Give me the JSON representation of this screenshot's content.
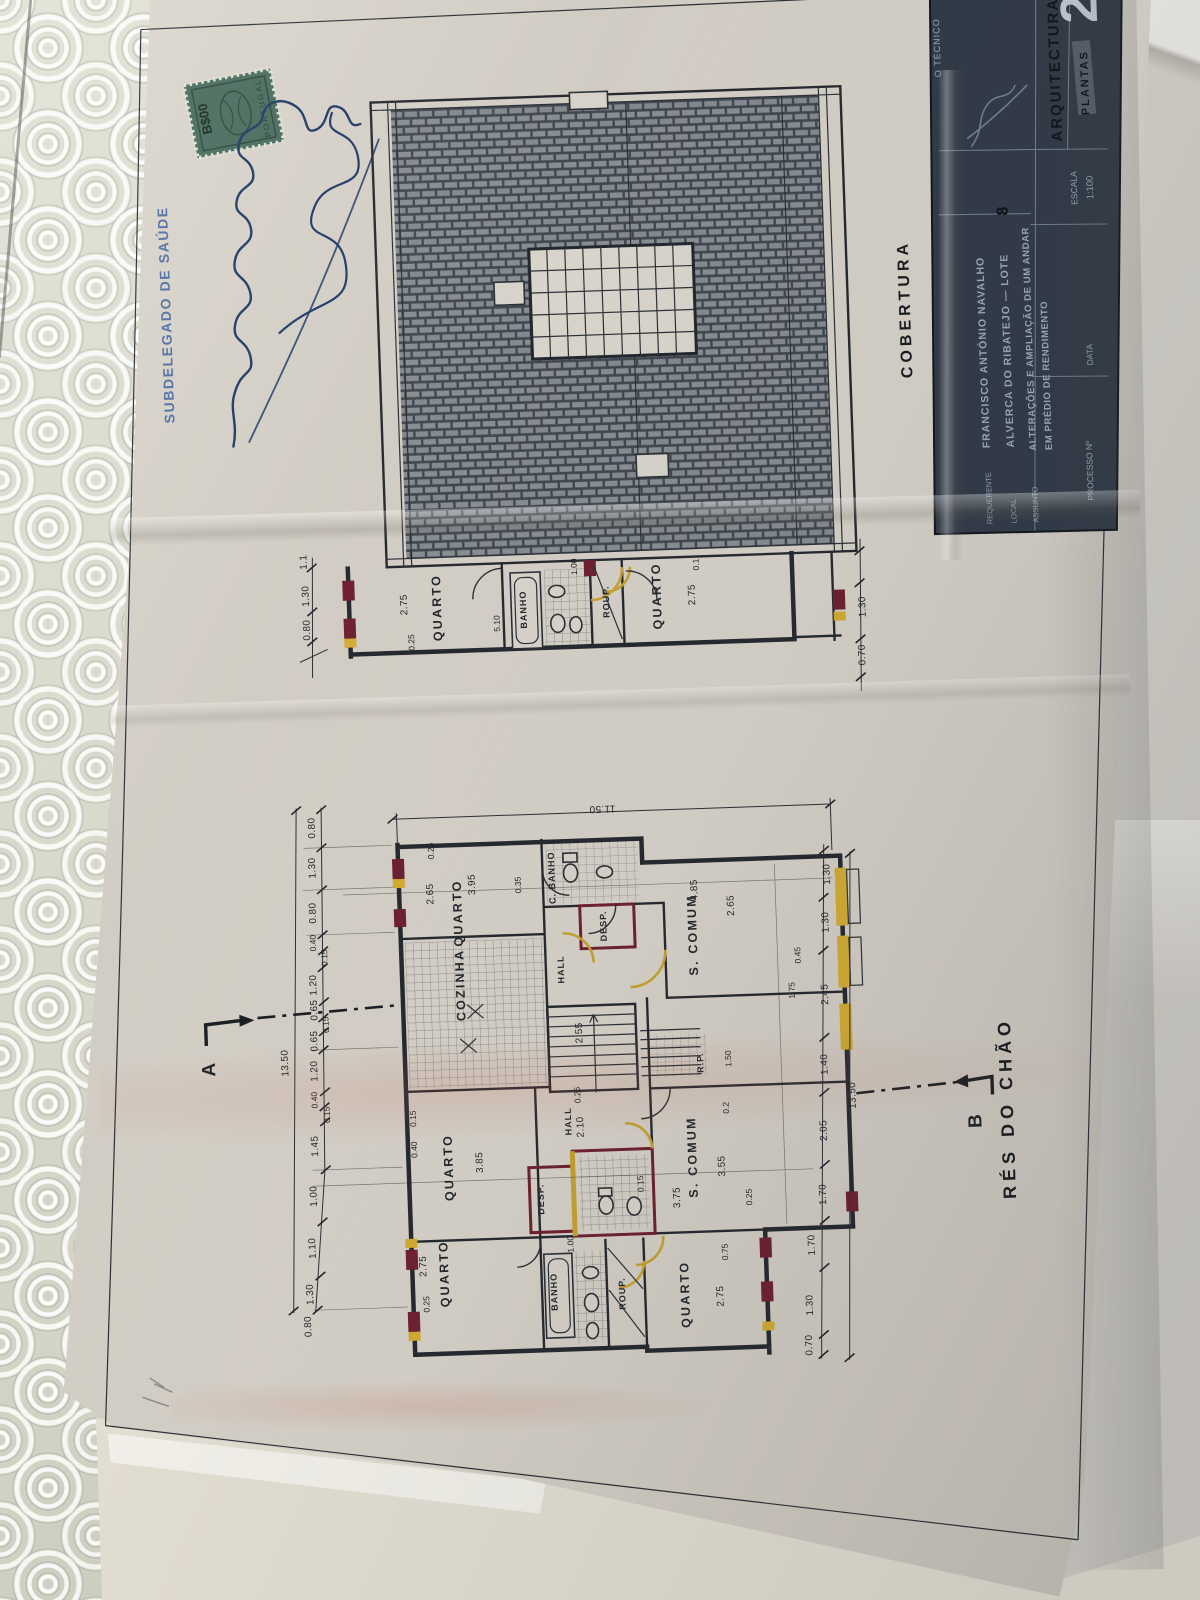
{
  "stamp_area": {
    "subdelegado_text": "SUBDELEGADO DE SAÚDE",
    "revenue_stamp_value": "B$00",
    "revenue_stamp_country": "PORTUGAL"
  },
  "title_block": {
    "sheet_number": "2",
    "tecnico_label": "O TÉCNICO",
    "discipline": "ARQUITECTURA",
    "sheet_type": "PLANTAS",
    "escala_label": "ESCALA",
    "escala_value": "1:100",
    "data_label": "DATA",
    "processo_label": "PROCESSO Nº",
    "requerente_label": "REQUERENTE",
    "requerente_value": "FRANCISCO ANTÓNIO NAVALHO",
    "local_label": "LOCAL",
    "local_value": "ALVERCA DO RIBATEJO — LOTE",
    "local_lot_number": "8",
    "assunto_label": "ASSUNTO",
    "assunto_line1": "ALTERAÇÕES E AMPLIAÇÃO DE UM ANDAR",
    "assunto_line2": "EM PRÉDIO DE RENDIMENTO"
  },
  "plan_titles": {
    "roof": "COBERTURA",
    "ground_floor": "RÉS DO CHÃO",
    "section_a": "A",
    "section_b": "B"
  },
  "rooms": {
    "quarto": "QUARTO",
    "banho": "BANHO",
    "c_banho": "C. BANHO",
    "desp": "DESP.",
    "hall": "HALL",
    "s_comum": "S. COMUM",
    "cozinha": "COZINHA",
    "roup": "ROUP.",
    "rp": "R.P."
  },
  "dims": {
    "overall_width": "11.50",
    "overall_left": "13.50",
    "overall_right": "13.50",
    "left_chain": [
      "0.80",
      "1.30",
      "0.80",
      "0.40",
      "0.15",
      "1.20",
      "0.65",
      "0.15",
      "0.65",
      "1.20",
      "0.40",
      "0.15",
      "1.45",
      "1.00",
      "1.10",
      "1.30",
      "0.80"
    ],
    "right_chain": [
      "1.30",
      "1.30",
      "2.45",
      "1.40",
      "2.05",
      "1.70"
    ],
    "right_lower_chain": [
      "1.70",
      "1.30",
      "0.70"
    ],
    "mid_left_chain": [
      "1.1",
      "1.30",
      "0.80"
    ],
    "mid_right_chain": [
      "1.30",
      "0.70"
    ],
    "mid_top": "1.00",
    "upper_quarto_left": [
      "2.75",
      "0.25"
    ],
    "upper_banho": "5.10",
    "upper_quarto_right": [
      "2.75",
      "0.1"
    ],
    "quarto_tl": [
      "3.95",
      "2.65",
      "0.25",
      "0.35"
    ],
    "s_comum_tr": [
      "4.85",
      "2.65",
      "0.45",
      "1.75",
      "1.50"
    ],
    "quarto_ml": [
      "3.85",
      "0.40",
      "0.15"
    ],
    "hall_lower": [
      "2.10",
      "0.25"
    ],
    "stairs": "2.55",
    "s_comum_b": [
      "3.55",
      "3.75",
      "0.25",
      "0.2"
    ],
    "wc_center": [
      "1.00",
      "0.15"
    ],
    "quarto_bl": [
      "2.75",
      "0.25"
    ],
    "quarto_br": [
      "2.75",
      "0.75"
    ]
  }
}
